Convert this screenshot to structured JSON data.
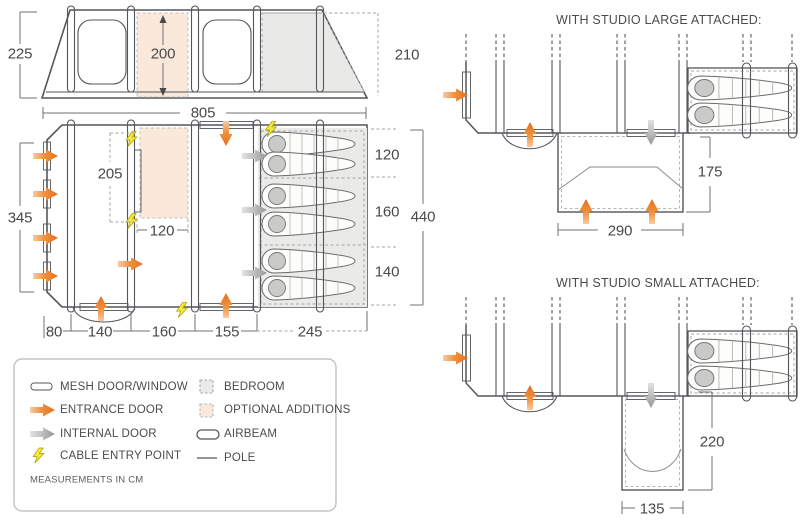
{
  "elevation": {
    "left_height": "225",
    "inner_height": "200",
    "rear_height": "210",
    "length": "805"
  },
  "plan": {
    "front_width": "345",
    "optional_length": "205",
    "optional_width": "120",
    "bottom_segments": [
      "80",
      "140",
      "160",
      "155",
      "245"
    ],
    "bedroom_sections": [
      "120",
      "160",
      "140"
    ],
    "total_depth": "440"
  },
  "studio_large": {
    "title": "WITH STUDIO LARGE ATTACHED:",
    "depth": "175",
    "width": "290"
  },
  "studio_small": {
    "title": "WITH STUDIO SMALL ATTACHED:",
    "depth": "220",
    "width": "135"
  },
  "legend": {
    "items_left": [
      {
        "icon": "mesh-door-window-icon",
        "label": "MESH DOOR/WINDOW"
      },
      {
        "icon": "entrance-door-arrow-icon",
        "label": "ENTRANCE DOOR"
      },
      {
        "icon": "internal-door-arrow-icon",
        "label": "INTERNAL DOOR"
      },
      {
        "icon": "cable-entry-bolt-icon",
        "label": "CABLE ENTRY POINT"
      }
    ],
    "items_right": [
      {
        "icon": "bedroom-swatch-icon",
        "label": "BEDROOM"
      },
      {
        "icon": "optional-additions-swatch-icon",
        "label": "OPTIONAL ADDITIONS"
      },
      {
        "icon": "airbeam-icon",
        "label": "AIRBEAM"
      },
      {
        "icon": "pole-icon",
        "label": "POLE"
      }
    ],
    "note": "MEASUREMENTS IN CM"
  },
  "colors": {
    "entrance_door": "#E4701E",
    "internal_door": "#9B9B9B",
    "cable_entry": "#F6E63A",
    "bedroom_fill": "#EAEAE8",
    "optional_fill": "#FAE8DA",
    "outline": "#55565A",
    "text": "#48494B"
  }
}
